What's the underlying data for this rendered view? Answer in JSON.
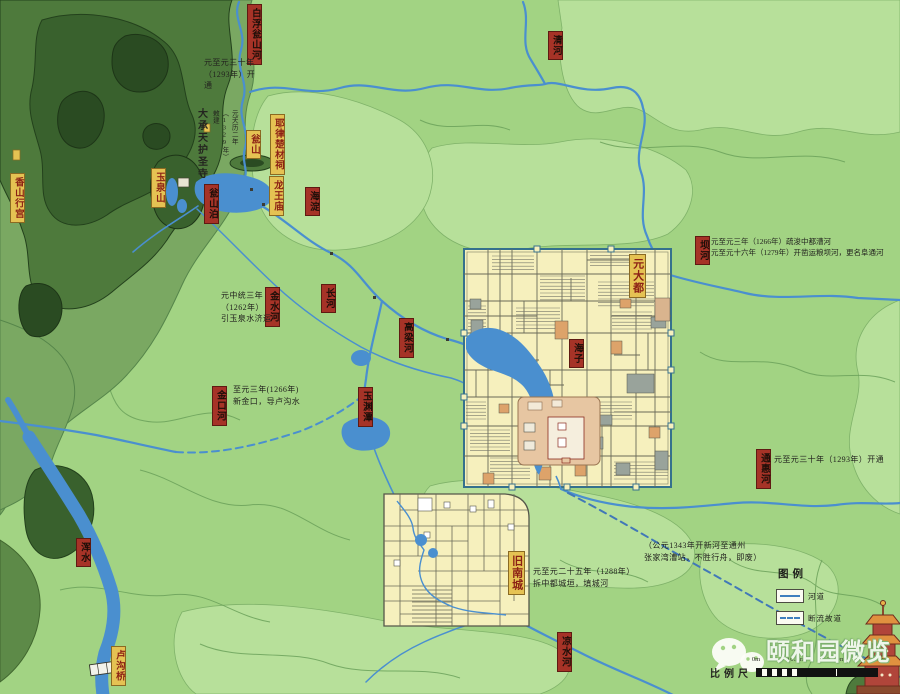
{
  "map_labels": [
    {
      "id": "baifu",
      "text": "白浮瓮山河",
      "kind": "river"
    },
    {
      "id": "qinghe",
      "text": "清河",
      "kind": "river"
    },
    {
      "id": "wengshanpo",
      "text": "瓮山泊",
      "kind": "river"
    },
    {
      "id": "haidian",
      "text": "海淀",
      "kind": "river"
    },
    {
      "id": "jinshuihe",
      "text": "金水河",
      "kind": "river"
    },
    {
      "id": "changhe",
      "text": "长河",
      "kind": "river"
    },
    {
      "id": "gaolianghe",
      "text": "高梁河",
      "kind": "river"
    },
    {
      "id": "jinkouhe",
      "text": "金口河",
      "kind": "river"
    },
    {
      "id": "yuyuantan",
      "text": "玉渊潭",
      "kind": "river"
    },
    {
      "id": "haizi",
      "text": "海子",
      "kind": "river"
    },
    {
      "id": "bahe",
      "text": "坝河",
      "kind": "river"
    },
    {
      "id": "tonghuihe",
      "text": "通惠河",
      "kind": "river"
    },
    {
      "id": "liangshuihe",
      "text": "凉水河",
      "kind": "river"
    },
    {
      "id": "hunshui",
      "text": "浑水",
      "kind": "river"
    },
    {
      "id": "xiangshan",
      "text": "香山行宫",
      "kind": "place"
    },
    {
      "id": "yuquanshan",
      "text": "玉泉山",
      "kind": "place"
    },
    {
      "id": "wengshan",
      "text": "瓮山",
      "kind": "place"
    },
    {
      "id": "yelu",
      "text": "耶律楚材祠",
      "kind": "place"
    },
    {
      "id": "longwang",
      "text": "龙王庙",
      "kind": "place"
    },
    {
      "id": "lugouqiao",
      "text": "卢沟桥",
      "kind": "place"
    },
    {
      "id": "jiunancheng",
      "text": "旧南城",
      "kind": "place"
    },
    {
      "id": "yuandadu",
      "text": "元大都",
      "kind": "place"
    },
    {
      "id": "dachengtian",
      "text": "大承天护圣寺",
      "kind": "text-vert"
    },
    {
      "id": "note-1329",
      "text": "元天历二年（1329年）敕建",
      "kind": "note-vert"
    },
    {
      "id": "note-1293n",
      "text": "元至元三十年\n（1293年）开\n通",
      "kind": "note"
    },
    {
      "id": "note-1262",
      "text": "元中统三年\n（1262年）\n引玉泉水济运",
      "kind": "note"
    },
    {
      "id": "note-1266jk",
      "text": "至元三年(1266年)\n新金口，导卢沟水",
      "kind": "note"
    },
    {
      "id": "note-bahe",
      "text": "元至元三年（1266年）疏浚中都漕河\n元至元十六年（1279年）开凿运粮坝河，更名阜通河",
      "kind": "note"
    },
    {
      "id": "note-1293s",
      "text": "元至元三十年（1293年）开通",
      "kind": "note"
    },
    {
      "id": "note-1343",
      "text": "（公元1343年开新河至通州\n张家湾漕站，不胜行舟，即废）",
      "kind": "note"
    },
    {
      "id": "note-1288",
      "text": "元至元二十五年（1288年）\n拆中都城垣，填城河",
      "kind": "note"
    }
  ],
  "legend": {
    "title": "图例",
    "items": [
      {
        "label": "河道",
        "style": "solid"
      },
      {
        "label": "断流故道",
        "style": "dashed"
      }
    ]
  },
  "scale_bar": {
    "label": "比例尺",
    "ticks": [
      "0m",
      "1000m",
      "2000m",
      "3000m"
    ]
  },
  "watermark": {
    "text": "颐和园微览",
    "icon": "wechat-icon"
  },
  "colors": {
    "plain_green": "#a2d383",
    "light_green": "#b7e09a",
    "hill_green": "#7aa862",
    "dark_mountain": "#39612d",
    "river_blue": "#4a8fcf",
    "city_fill": "#f6f0bd",
    "palace_fill": "#e7c6a2",
    "label_red": "#a63327",
    "label_yellow": "#e5c253"
  }
}
